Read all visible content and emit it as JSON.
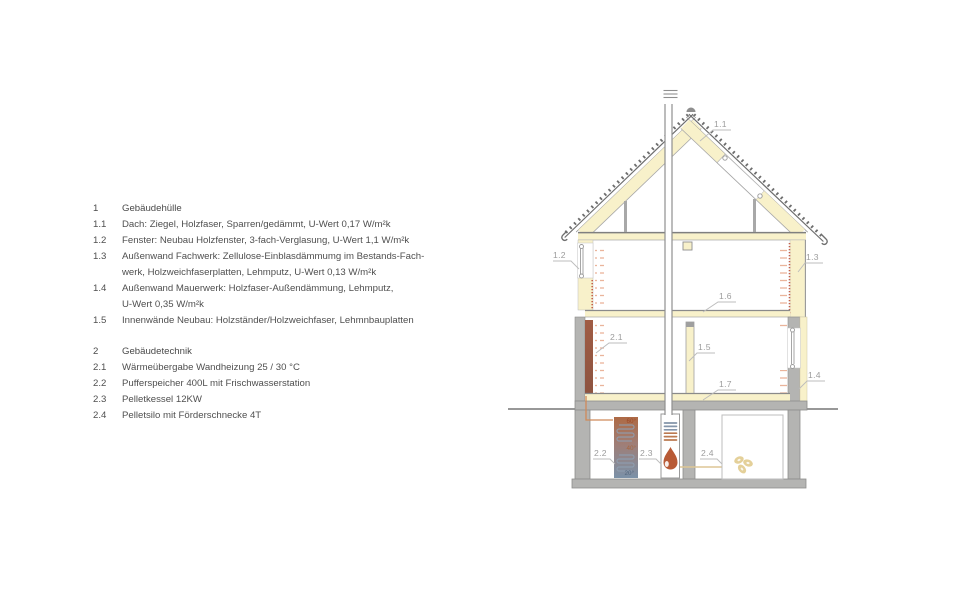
{
  "title": "Gebäudeschnitt Sanierungskonzept",
  "legend": {
    "sections": [
      {
        "number": "1",
        "title": "Gebäudehülle",
        "items": [
          {
            "number": "1.1",
            "lines": [
              "Dach: Ziegel, Holzfaser, Sparren/gedämmt, U-Wert 0,17 W/m²k"
            ]
          },
          {
            "number": "1.2",
            "lines": [
              "Fenster: Neubau Holzfenster, 3-fach-Verglasung, U-Wert 1,1 W/m²k"
            ]
          },
          {
            "number": "1.3",
            "lines": [
              "Außenwand Fachwerk: Zellulose-Einblasdämmumg im Bestands-Fach-",
              "werk, Holzweichfaserplatten, Lehmputz, U-Wert 0,13 W/m²k"
            ]
          },
          {
            "number": "1.4",
            "lines": [
              "Außenwand Mauerwerk: Holzfaser-Außendämmung, Lehmputz,",
              "U-Wert 0,35 W/m²k"
            ]
          },
          {
            "number": "1.5",
            "lines": [
              "Innenwände Neubau: Holzständer/Holzweichfaser, Lehmnbauplatten"
            ]
          }
        ]
      },
      {
        "number": "2",
        "title": "Gebäudetechnik",
        "items": [
          {
            "number": "2.1",
            "lines": [
              "Wärmeübergabe Wandheizung 25 / 30 °C"
            ]
          },
          {
            "number": "2.2",
            "lines": [
              "Pufferspeicher 400L mit Frischwasserstation"
            ]
          },
          {
            "number": "2.3",
            "lines": [
              "Pelletkessel 12KW"
            ]
          },
          {
            "number": "2.4",
            "lines": [
              "Pelletsilo mit Förderschnecke 4T"
            ]
          }
        ]
      }
    ]
  },
  "drawing": {
    "callouts": {
      "c11": "1.1",
      "c12": "1.2",
      "c13": "1.3",
      "c14": "1.4",
      "c15": "1.5",
      "c16": "1.6",
      "c17": "1.7",
      "c21": "2.1",
      "c22": "2.2",
      "c23": "2.3",
      "c24": "2.4"
    },
    "buffer_temps": {
      "top": "60°",
      "middle": "40°",
      "bottom": "20°"
    },
    "colors": {
      "insulation_yellow": "#f8f1ca",
      "concrete_gray": "#b4b4b2",
      "wall_heating_strip": "#9a5a44",
      "tick_salmon": "#eab49b",
      "clay_dots_red": "#c4604a",
      "flame_orange": "#b85a36",
      "pellets_gold": "#e4d099",
      "buffer_warm": "#ae6a45",
      "buffer_cold": "#7b91a8",
      "label_gray": "#9c9c9c"
    }
  }
}
